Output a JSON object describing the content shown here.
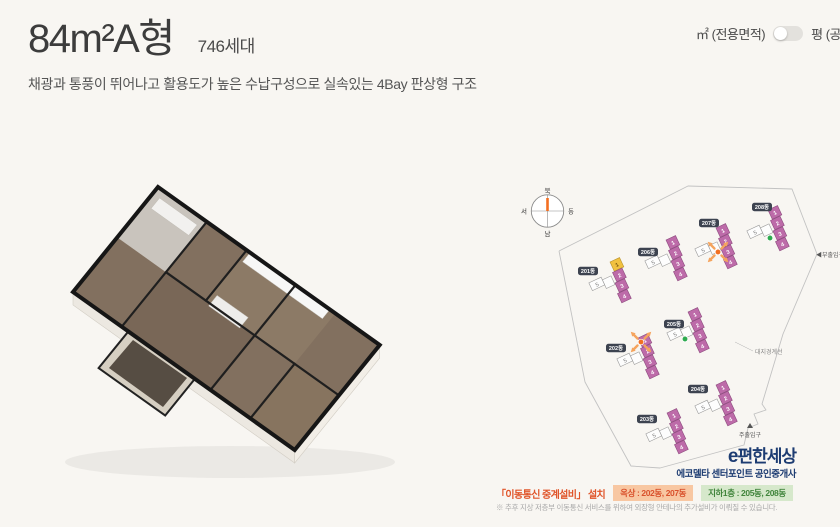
{
  "header": {
    "title": "84m²A형",
    "units_count": "746세대",
    "subtitle": "채광과 통풍이 뛰어나고 활용도가 높은 수납구성으로 실속있는 4Bay 판상형 구조"
  },
  "area_toggle": {
    "left_label": "㎡ (전용면적)",
    "right_label": "평 (공급면적)"
  },
  "site_plan": {
    "compass": {
      "north": "북",
      "south": "남",
      "east": "동",
      "west": "서"
    },
    "labels": {
      "sub_entrance": "◀부출입구",
      "site_boundary": "대지경계선",
      "main_entrance": "주출입구"
    },
    "colors": {
      "unit_pink": "#bd6ba9",
      "unit_pink_stroke": "#8d4b7e",
      "unit_white": "#fdfdfd",
      "unit_white_stroke": "#9a9a9a",
      "unit_yellow": "#f1c140",
      "unit_yellow_stroke": "#b8912a",
      "marker_rooftop": "#f26f21",
      "marker_arrow": "#f5a45e",
      "marker_basement": "#2daa4f",
      "label_bg": "#3d4350"
    },
    "buildings": [
      {
        "name": "201동",
        "x": 610,
        "y": 262,
        "rot": -25,
        "label_dx": -22,
        "label_dy": 9,
        "top_color": "yellow",
        "marker": null
      },
      {
        "name": "206동",
        "x": 666,
        "y": 240,
        "rot": -25,
        "label_dx": -18,
        "label_dy": 12,
        "top_color": null,
        "marker": null
      },
      {
        "name": "207동",
        "x": 716,
        "y": 228,
        "rot": -25,
        "label_dx": -7,
        "label_dy": -5,
        "top_color": null,
        "marker": {
          "type": "rooftop",
          "x": 718,
          "y": 252
        }
      },
      {
        "name": "208동",
        "x": 768,
        "y": 210,
        "rot": -25,
        "label_dx": -6,
        "label_dy": -3,
        "top_color": null,
        "marker": {
          "type": "basement",
          "x": 770,
          "y": 238
        }
      },
      {
        "name": "202동",
        "x": 638,
        "y": 338,
        "rot": -25,
        "label_dx": -22,
        "label_dy": 10,
        "top_color": null,
        "marker": {
          "type": "rooftop",
          "x": 641,
          "y": 342
        }
      },
      {
        "name": "205동",
        "x": 688,
        "y": 312,
        "rot": -25,
        "label_dx": -14,
        "label_dy": 12,
        "top_color": null,
        "marker": {
          "type": "basement",
          "x": 685,
          "y": 339
        }
      },
      {
        "name": "203동",
        "x": 667,
        "y": 413,
        "rot": -25,
        "label_dx": -20,
        "label_dy": 6,
        "top_color": null,
        "marker": null
      },
      {
        "name": "204동",
        "x": 716,
        "y": 385,
        "rot": -25,
        "label_dx": -18,
        "label_dy": 4,
        "top_color": null,
        "marker": null
      }
    ],
    "unit_numbers": [
      "1",
      "2",
      "3",
      "4"
    ],
    "side_unit_number": "5"
  },
  "logo": {
    "brand_initial": "e",
    "brand": "편한세상",
    "agency": "에코델타 센터포인트 공인중개사"
  },
  "legend": {
    "title": "「이동통신 중계설비」 설치",
    "rooftop_badge": "옥상 : 202동, 207동",
    "basement_badge": "지하1층 : 205동, 208동",
    "note": "※ 추후 지상 저층부 이동통신 서비스를 위하여 외장형 안테나의 추가설비가 이뤄질 수 있습니다."
  }
}
